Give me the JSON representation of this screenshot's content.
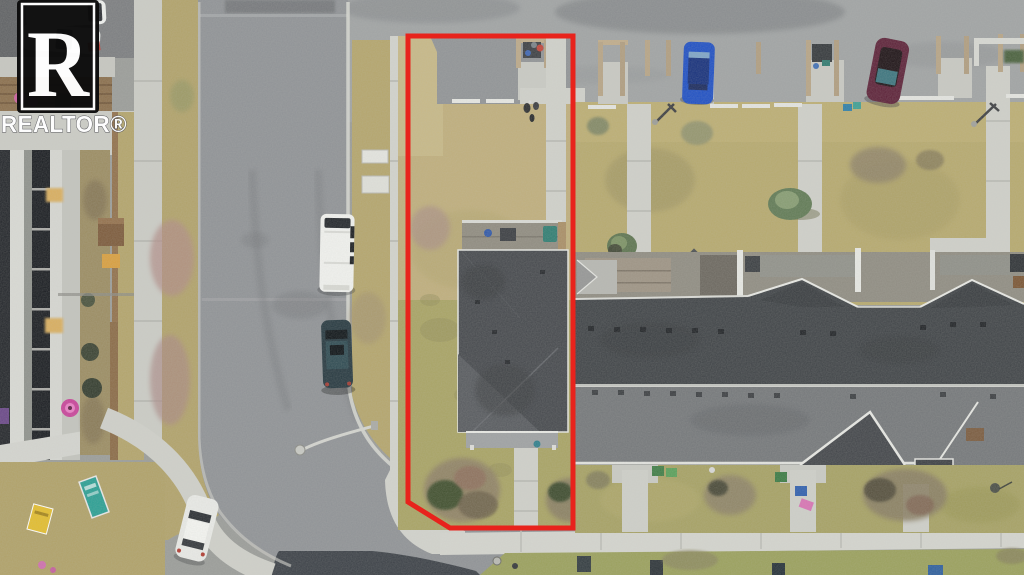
{
  "watermark": {
    "logo_letter": "R",
    "label": "REALTOR®"
  },
  "colors": {
    "outline_red": "#E8231C",
    "roof_dark": "#3F4347",
    "roof_light_slope": "#74777A",
    "end_unit_roof": "#45484D",
    "lawn_tan": "#BFAE7C",
    "lawn_olive": "#A3A05E",
    "road_asphalt": "#8F9296",
    "fresh_asphalt_patch": "#3B4047",
    "parking_asphalt": "#A0A3A4",
    "sidewalk_concrete": "#D2D3CD",
    "boulevard_grass": "#B4A56C",
    "van_white": "#F1F2EF",
    "suv_dark": "#263840",
    "sedan_white": "#E9EAE7",
    "car_blue": "#1E4FC4",
    "car_maroon": "#5C2138",
    "logo_black": "#0C0C0C",
    "logo_white": "#FFFFFF"
  },
  "scene": {
    "type": "aerial-drone-photo",
    "subject": "corner townhouse lot outlined in red",
    "vehicles": [
      {
        "name": "white-van-parked-on-street",
        "color": "#F1F2EF"
      },
      {
        "name": "dark-suv-parked-on-street",
        "color": "#263840"
      },
      {
        "name": "white-sedan-parked-at-corner",
        "color": "#E9EAE7"
      },
      {
        "name": "blue-car-in-parking-lot",
        "color": "#1E4FC4"
      },
      {
        "name": "maroon-car-in-parking-lot",
        "color": "#5C2138"
      },
      {
        "name": "white-car-top-left-upper",
        "color": "#EEF0EE"
      },
      {
        "name": "white-car-top-left-lower",
        "color": "#E8EAE8"
      }
    ]
  }
}
